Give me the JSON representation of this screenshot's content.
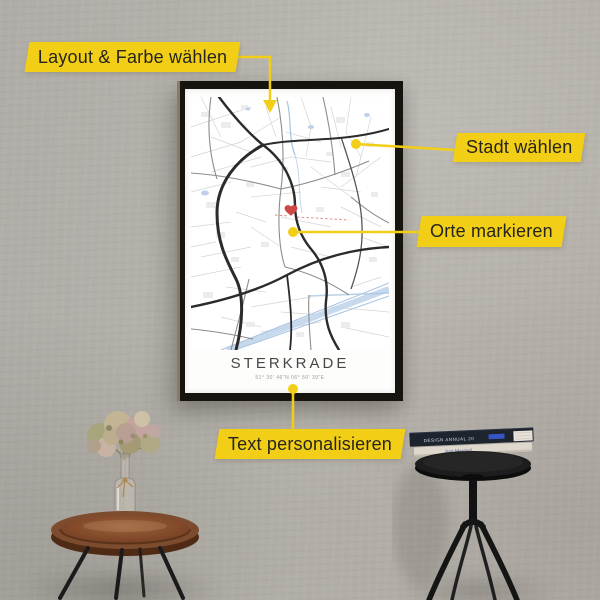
{
  "colors": {
    "accent_yellow": "#f2cf16",
    "wall": "#b3b0aa",
    "frame": "#17130f",
    "paper": "#fdfdfc",
    "heart_marker": "#ce4646",
    "label_text": "#26241e"
  },
  "callouts": {
    "layout": {
      "label": "Layout & Farbe wählen"
    },
    "city": {
      "label": "Stadt wählen"
    },
    "places": {
      "label": "Orte markieren"
    },
    "personalize": {
      "label": "Text personalisieren"
    }
  },
  "poster": {
    "title": "STERKRADE",
    "coordinates": "51° 30' 46\"N 06° 50' 39\"E"
  },
  "decor": {
    "book_top_spine": "DESIGN ANNUAL 20",
    "book_bottom_spine": "Just Married"
  }
}
